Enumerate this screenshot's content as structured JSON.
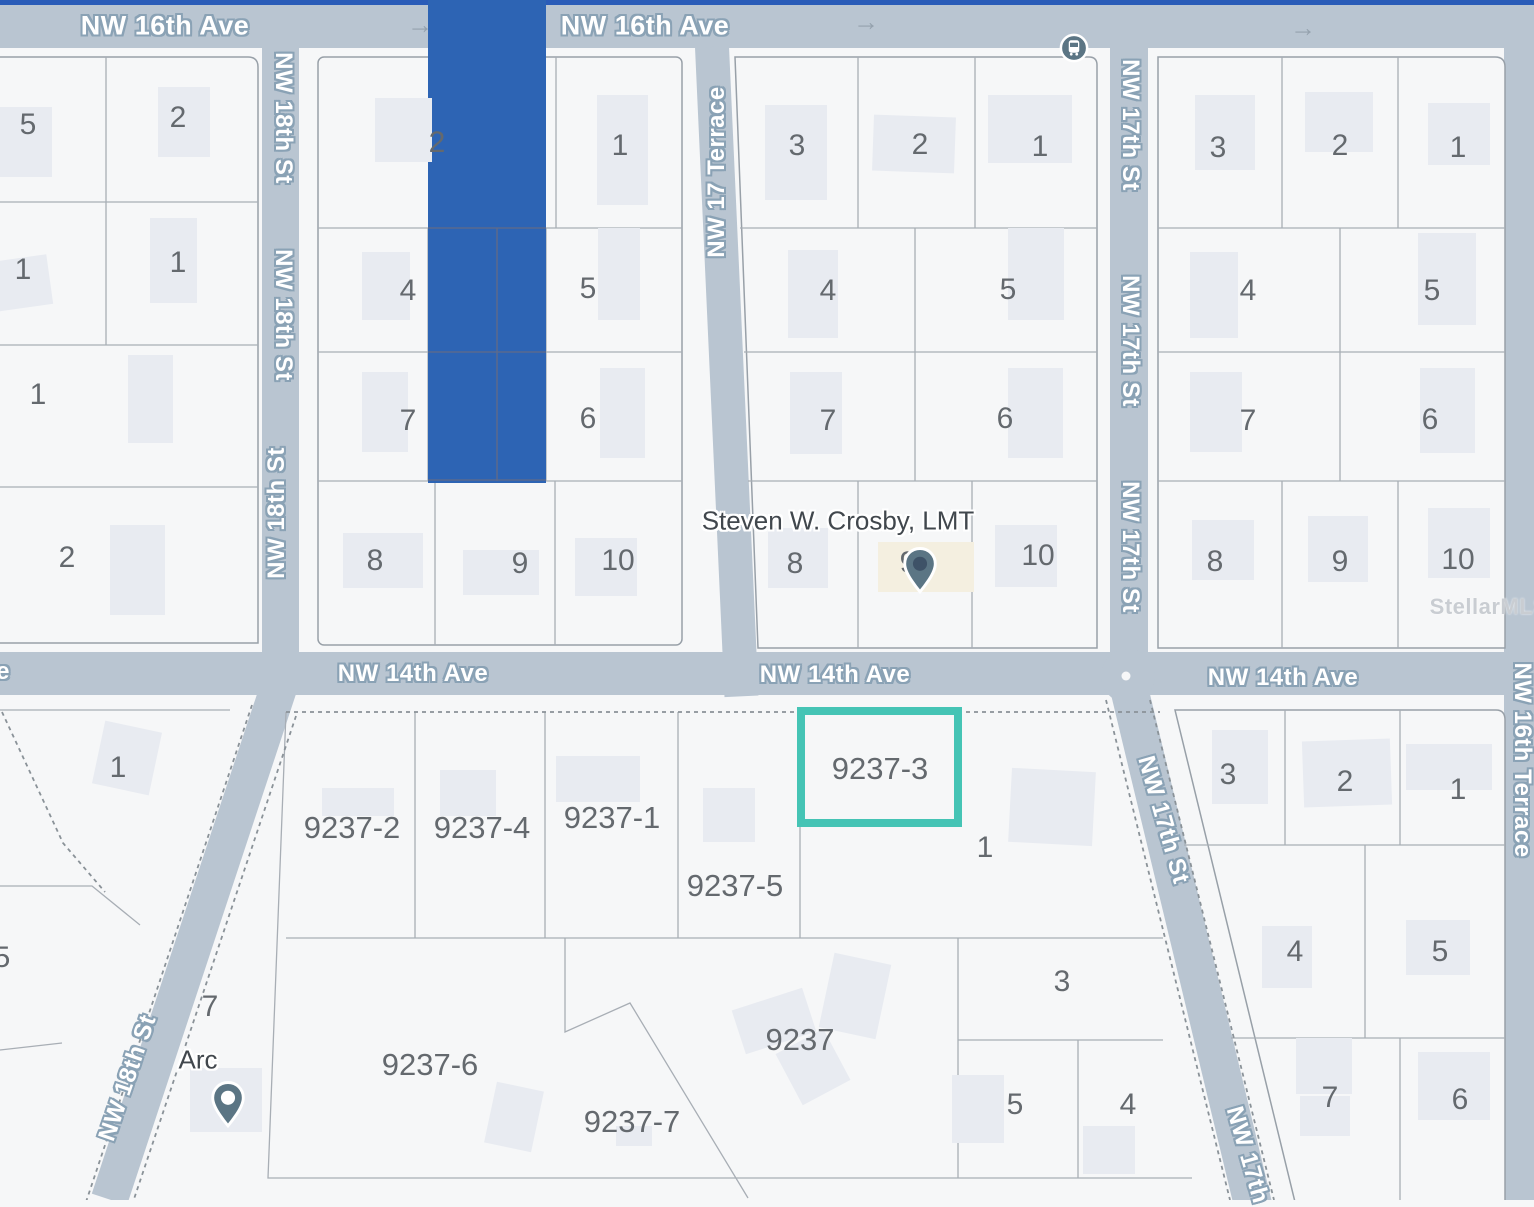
{
  "map": {
    "watermark": {
      "text": "StellarMLS",
      "x": 1489,
      "y": 607
    },
    "colors": {
      "road": "#b9c5d1",
      "parcel": "#f6f7f8",
      "building": "#e8ebf1",
      "building_alt": "#f4efe0",
      "lot_line": "#a8aeb5",
      "block_line": "#98a0a8",
      "dashed": "#8a9298",
      "blue": "#2d64b4",
      "blue_line": "#5a6a8e",
      "teal": "#45c4b5",
      "top_line": "#2a5cb8",
      "street_halo": "#8aa2b5",
      "lot_text": "#64696e",
      "poi_text": "#41474d",
      "pin": "#5b7584",
      "arrow": "#95a2ae",
      "watermark": "#c9cdd2"
    },
    "streets": [
      {
        "label": "NW 16th Ave",
        "x": 165,
        "y": 26,
        "rot": 0,
        "size": 27
      },
      {
        "label": "NW 16th Ave",
        "x": 645,
        "y": 26,
        "rot": 0,
        "size": 27
      },
      {
        "label": "NW 18th St",
        "x": 283,
        "y": 118,
        "rot": 90
      },
      {
        "label": "NW 18th St",
        "x": 283,
        "y": 315,
        "rot": 90
      },
      {
        "label": "NW 18th St",
        "x": 277,
        "y": 513,
        "rot": -90
      },
      {
        "label": "NW 17 Terrace",
        "x": 717,
        "y": 172,
        "rot": -90
      },
      {
        "label": "NW 17th St",
        "x": 1130,
        "y": 125,
        "rot": 90
      },
      {
        "label": "NW 17th St",
        "x": 1130,
        "y": 341,
        "rot": 90
      },
      {
        "label": "NW 17th St",
        "x": 1130,
        "y": 547,
        "rot": 90
      },
      {
        "label": "NW 14th Ave",
        "x": 413,
        "y": 674,
        "rot": 0
      },
      {
        "label": "NW 14th Ave",
        "x": 835,
        "y": 675,
        "rot": 0
      },
      {
        "label": "NW 14th Ave",
        "x": 1283,
        "y": 678,
        "rot": 0
      },
      {
        "label": "e",
        "x": 3,
        "y": 672,
        "rot": 0
      },
      {
        "label": "NW 18th St",
        "x": 128,
        "y": 1078,
        "rot": -71
      },
      {
        "label": "NW 17th St",
        "x": 1163,
        "y": 820,
        "rot": 74
      },
      {
        "label": "NW 17th",
        "x": 1247,
        "y": 1155,
        "rot": 74
      },
      {
        "label": "NW 16th Terrace",
        "x": 1522,
        "y": 760,
        "rot": 90
      }
    ],
    "direction_arrows": [
      {
        "glyph": "→",
        "x": 420,
        "y": 25
      },
      {
        "glyph": "→",
        "x": 866,
        "y": 22
      },
      {
        "glyph": "→",
        "x": 1303,
        "y": 28
      }
    ],
    "lot_numbers": [
      {
        "n": "5",
        "x": 28,
        "y": 125
      },
      {
        "n": "2",
        "x": 178,
        "y": 118
      },
      {
        "n": "1",
        "x": 23,
        "y": 270
      },
      {
        "n": "1",
        "x": 178,
        "y": 263
      },
      {
        "n": "1",
        "x": 38,
        "y": 395
      },
      {
        "n": "2",
        "x": 67,
        "y": 558
      },
      {
        "n": "2",
        "x": 437,
        "y": 143
      },
      {
        "n": "1",
        "x": 620,
        "y": 146
      },
      {
        "n": "4",
        "x": 408,
        "y": 291
      },
      {
        "n": "5",
        "x": 588,
        "y": 289
      },
      {
        "n": "7",
        "x": 408,
        "y": 421
      },
      {
        "n": "6",
        "x": 588,
        "y": 419
      },
      {
        "n": "8",
        "x": 375,
        "y": 561
      },
      {
        "n": "9",
        "x": 520,
        "y": 564
      },
      {
        "n": "10",
        "x": 618,
        "y": 561
      },
      {
        "n": "3",
        "x": 797,
        "y": 146
      },
      {
        "n": "2",
        "x": 920,
        "y": 145
      },
      {
        "n": "1",
        "x": 1040,
        "y": 147
      },
      {
        "n": "4",
        "x": 828,
        "y": 291
      },
      {
        "n": "5",
        "x": 1008,
        "y": 290
      },
      {
        "n": "7",
        "x": 828,
        "y": 421
      },
      {
        "n": "6",
        "x": 1005,
        "y": 419
      },
      {
        "n": "8",
        "x": 795,
        "y": 564
      },
      {
        "n": "9",
        "x": 908,
        "y": 563
      },
      {
        "n": "10",
        "x": 1038,
        "y": 556
      },
      {
        "n": "3",
        "x": 1218,
        "y": 148
      },
      {
        "n": "2",
        "x": 1340,
        "y": 146
      },
      {
        "n": "1",
        "x": 1458,
        "y": 148
      },
      {
        "n": "4",
        "x": 1248,
        "y": 291
      },
      {
        "n": "5",
        "x": 1432,
        "y": 291
      },
      {
        "n": "7",
        "x": 1248,
        "y": 421
      },
      {
        "n": "6",
        "x": 1430,
        "y": 420
      },
      {
        "n": "8",
        "x": 1215,
        "y": 562
      },
      {
        "n": "9",
        "x": 1340,
        "y": 562
      },
      {
        "n": "10",
        "x": 1458,
        "y": 560
      },
      {
        "n": "1",
        "x": 118,
        "y": 768
      },
      {
        "n": "5",
        "x": 2,
        "y": 958
      },
      {
        "n": "7",
        "x": 210,
        "y": 1007
      },
      {
        "n": "1",
        "x": 985,
        "y": 848
      },
      {
        "n": "3",
        "x": 1062,
        "y": 982
      },
      {
        "n": "5",
        "x": 1015,
        "y": 1105
      },
      {
        "n": "4",
        "x": 1128,
        "y": 1105
      },
      {
        "n": "3",
        "x": 1228,
        "y": 775
      },
      {
        "n": "2",
        "x": 1345,
        "y": 782
      },
      {
        "n": "1",
        "x": 1458,
        "y": 790
      },
      {
        "n": "4",
        "x": 1295,
        "y": 952
      },
      {
        "n": "5",
        "x": 1440,
        "y": 952
      },
      {
        "n": "7",
        "x": 1330,
        "y": 1098
      },
      {
        "n": "6",
        "x": 1460,
        "y": 1100
      }
    ],
    "parcel_labels": [
      {
        "n": "9237-2",
        "x": 352,
        "y": 828
      },
      {
        "n": "9237-4",
        "x": 482,
        "y": 828
      },
      {
        "n": "9237-1",
        "x": 612,
        "y": 818
      },
      {
        "n": "9237-5",
        "x": 735,
        "y": 886
      },
      {
        "n": "9237-3",
        "x": 880,
        "y": 769
      },
      {
        "n": "9237-6",
        "x": 430,
        "y": 1065
      },
      {
        "n": "9237-7",
        "x": 632,
        "y": 1122
      },
      {
        "n": "9237",
        "x": 800,
        "y": 1040
      }
    ],
    "pois": [
      {
        "label": "Steven W. Crosby, LMT",
        "label_x": 838,
        "label_y": 521,
        "pin_x": 920,
        "pin_y": 563,
        "hole": "#3e5267"
      },
      {
        "label": "Arc",
        "label_x": 198,
        "label_y": 1060,
        "pin_x": 228,
        "pin_y": 1097,
        "hole": "#ffffff"
      }
    ],
    "transit_stop": {
      "x": 1074,
      "y": 48
    },
    "selected_parcel": {
      "id": "9237-3",
      "x": 797,
      "y": 707,
      "w": 165,
      "h": 120
    }
  }
}
